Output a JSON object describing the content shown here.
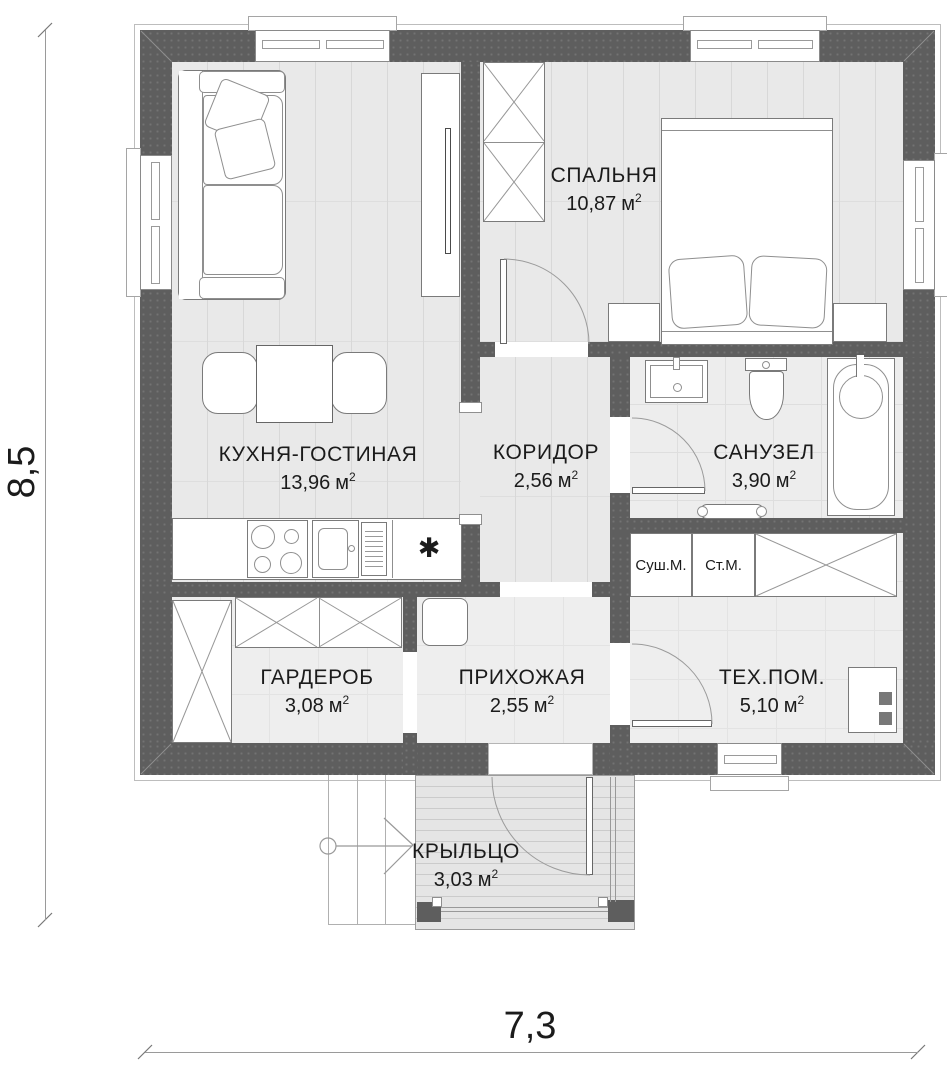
{
  "plan": {
    "unit": "м",
    "unit_sup": "2",
    "dim_height": "8,5",
    "dim_width": "7,3",
    "fridge_symbol": "✱",
    "rooms": [
      {
        "id": "bedroom",
        "name": "СПАЛЬНЯ",
        "area": "10,87"
      },
      {
        "id": "kitchen-living",
        "name": "КУХНЯ-ГОСТИНАЯ",
        "area": "13,96"
      },
      {
        "id": "corridor",
        "name": "КОРИДОР",
        "area": "2,56"
      },
      {
        "id": "bathroom",
        "name": "САНУЗЕЛ",
        "area": "3,90"
      },
      {
        "id": "wardrobe",
        "name": "ГАРДЕРОБ",
        "area": "3,08"
      },
      {
        "id": "hallway",
        "name": "ПРИХОЖАЯ",
        "area": "2,55"
      },
      {
        "id": "tech-room",
        "name": "ТЕХ.ПОМ.",
        "area": "5,10"
      },
      {
        "id": "porch",
        "name": "КРЫЛЬЦО",
        "area": "3,03"
      }
    ],
    "appliances": {
      "dryer": "Суш.М.",
      "washer": "Ст.М."
    },
    "colors": {
      "wall": "#5e5e5e",
      "floor": "#e9e9e9",
      "floor_line": "#d8d8d8",
      "outline": "#9a9a9a",
      "text": "#1b1b1b"
    }
  }
}
